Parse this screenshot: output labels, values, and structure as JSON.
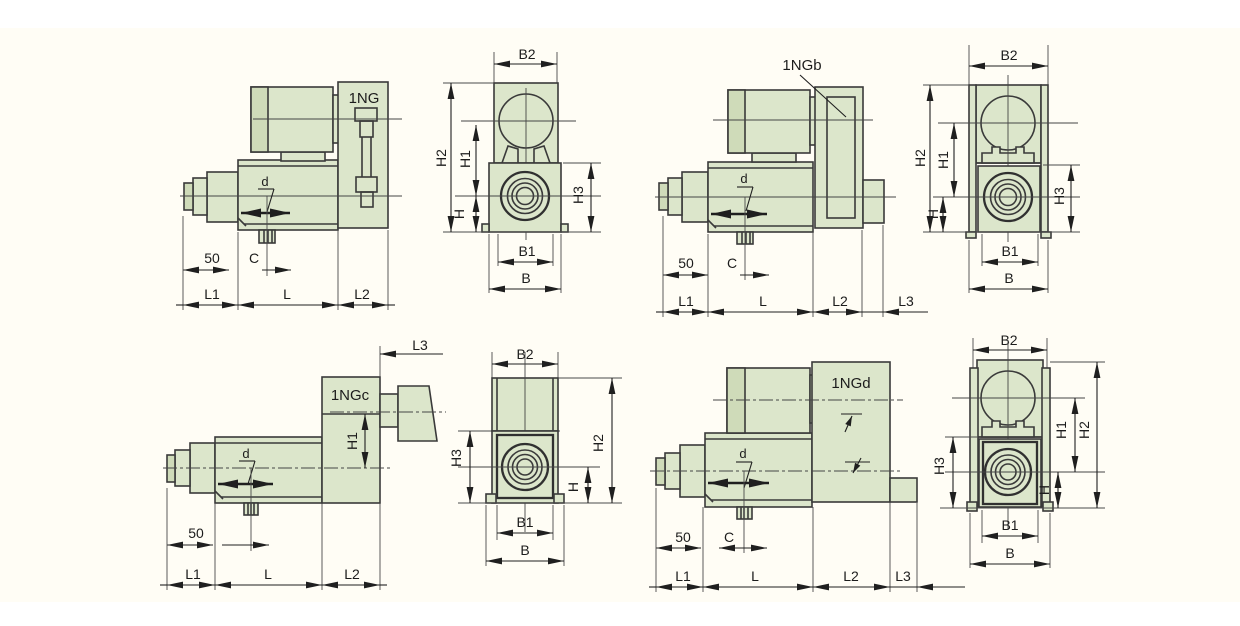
{
  "page": {
    "background": "#ffffff",
    "paper": "#fffdf5"
  },
  "colors": {
    "body_fill": "#dce6cb",
    "body_fill_dark": "#cfdbb9",
    "outline": "#3a3a3a",
    "dimension": "#1f1f1f"
  },
  "views": {
    "ng_side": {
      "variant": "1NG",
      "labels": {
        "d": "d",
        "n50": "50",
        "c": "C",
        "l1": "L1",
        "l": "L",
        "l2": "L2"
      }
    },
    "ng_front": {
      "labels": {
        "b2": "B2",
        "h2": "H2",
        "h1": "H1",
        "h": "H",
        "h3": "H3",
        "b1": "B1",
        "b": "B"
      }
    },
    "ngb_side": {
      "variant": "1NGb",
      "labels": {
        "d": "d",
        "n50": "50",
        "c": "C",
        "l1": "L1",
        "l": "L",
        "l2": "L2",
        "l3": "L3"
      }
    },
    "ngb_front": {
      "labels": {
        "b2": "B2",
        "h2": "H2",
        "h1": "H1",
        "h": "H",
        "h3": "H3",
        "b1": "B1",
        "b": "B"
      }
    },
    "ngc_side": {
      "variant": "1NGc",
      "labels": {
        "d": "d",
        "n50": "50",
        "h1": "H1",
        "l1": "L1",
        "l": "L",
        "l2": "L2",
        "l3": "L3"
      }
    },
    "ngc_front": {
      "labels": {
        "b2": "B2",
        "h3": "H3",
        "h2": "H2",
        "h": "H",
        "b1": "B1",
        "b": "B"
      }
    },
    "ngd_side": {
      "variant": "1NGd",
      "labels": {
        "d": "d",
        "n50": "50",
        "c": "C",
        "l1": "L1",
        "l": "L",
        "l2": "L2",
        "l3": "L3"
      }
    },
    "ngd_front": {
      "labels": {
        "b2": "B2",
        "h3": "H3",
        "h1": "H1",
        "h2": "H2",
        "h": "H",
        "b1": "B1",
        "b": "B"
      }
    }
  }
}
